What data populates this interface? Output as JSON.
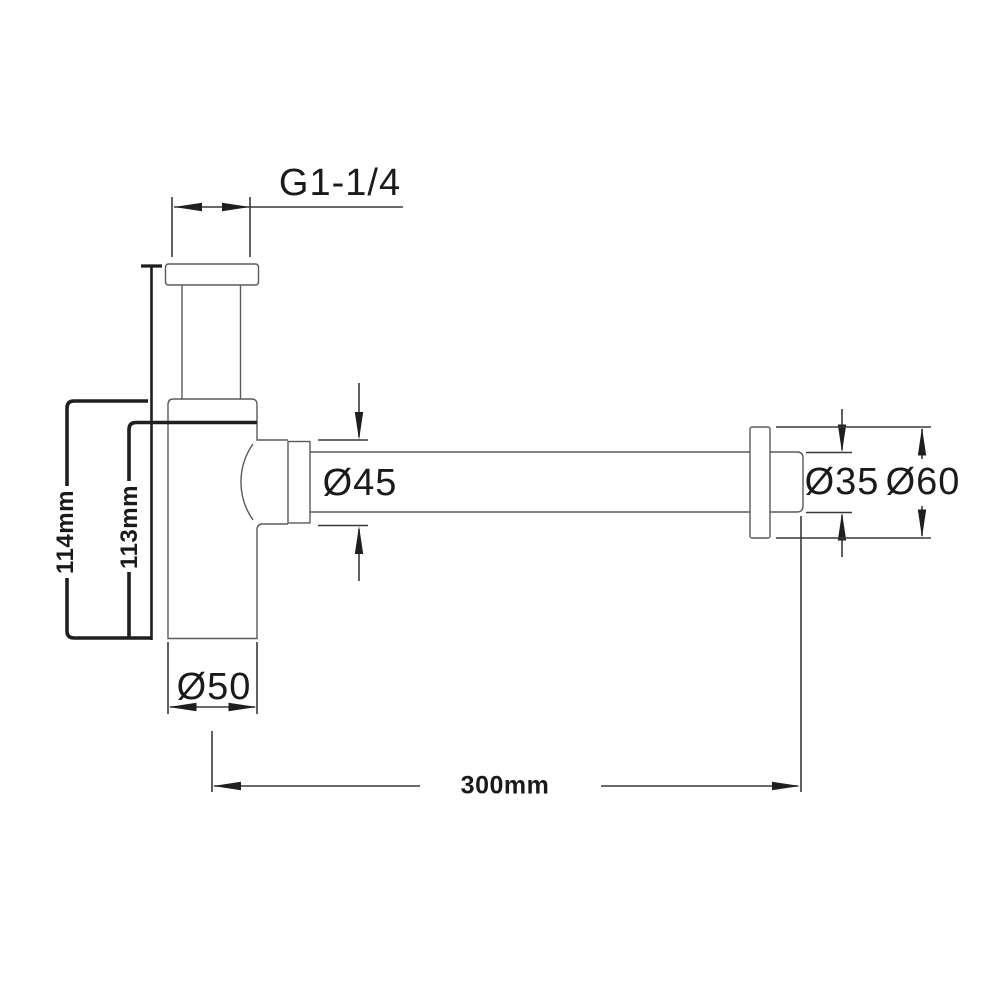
{
  "drawing": {
    "type": "technical-drawing",
    "subject": "bottle trap with horizontal outlet pipe and wall flange",
    "colors": {
      "background": "#ffffff",
      "outline": "#5a5a5a",
      "dimension_line": "#3a3a3a",
      "thick_bracket": "#1f1f1f",
      "text": "#1a1a1a"
    },
    "labels": {
      "thread": "G1-1/4",
      "nut_dia": "Ø45",
      "pipe_dia": "Ø35",
      "flange_dia": "Ø60",
      "body_dia": "Ø50",
      "height_overall": "114mm",
      "height_body": "113mm",
      "length_pipe": "300mm"
    }
  }
}
